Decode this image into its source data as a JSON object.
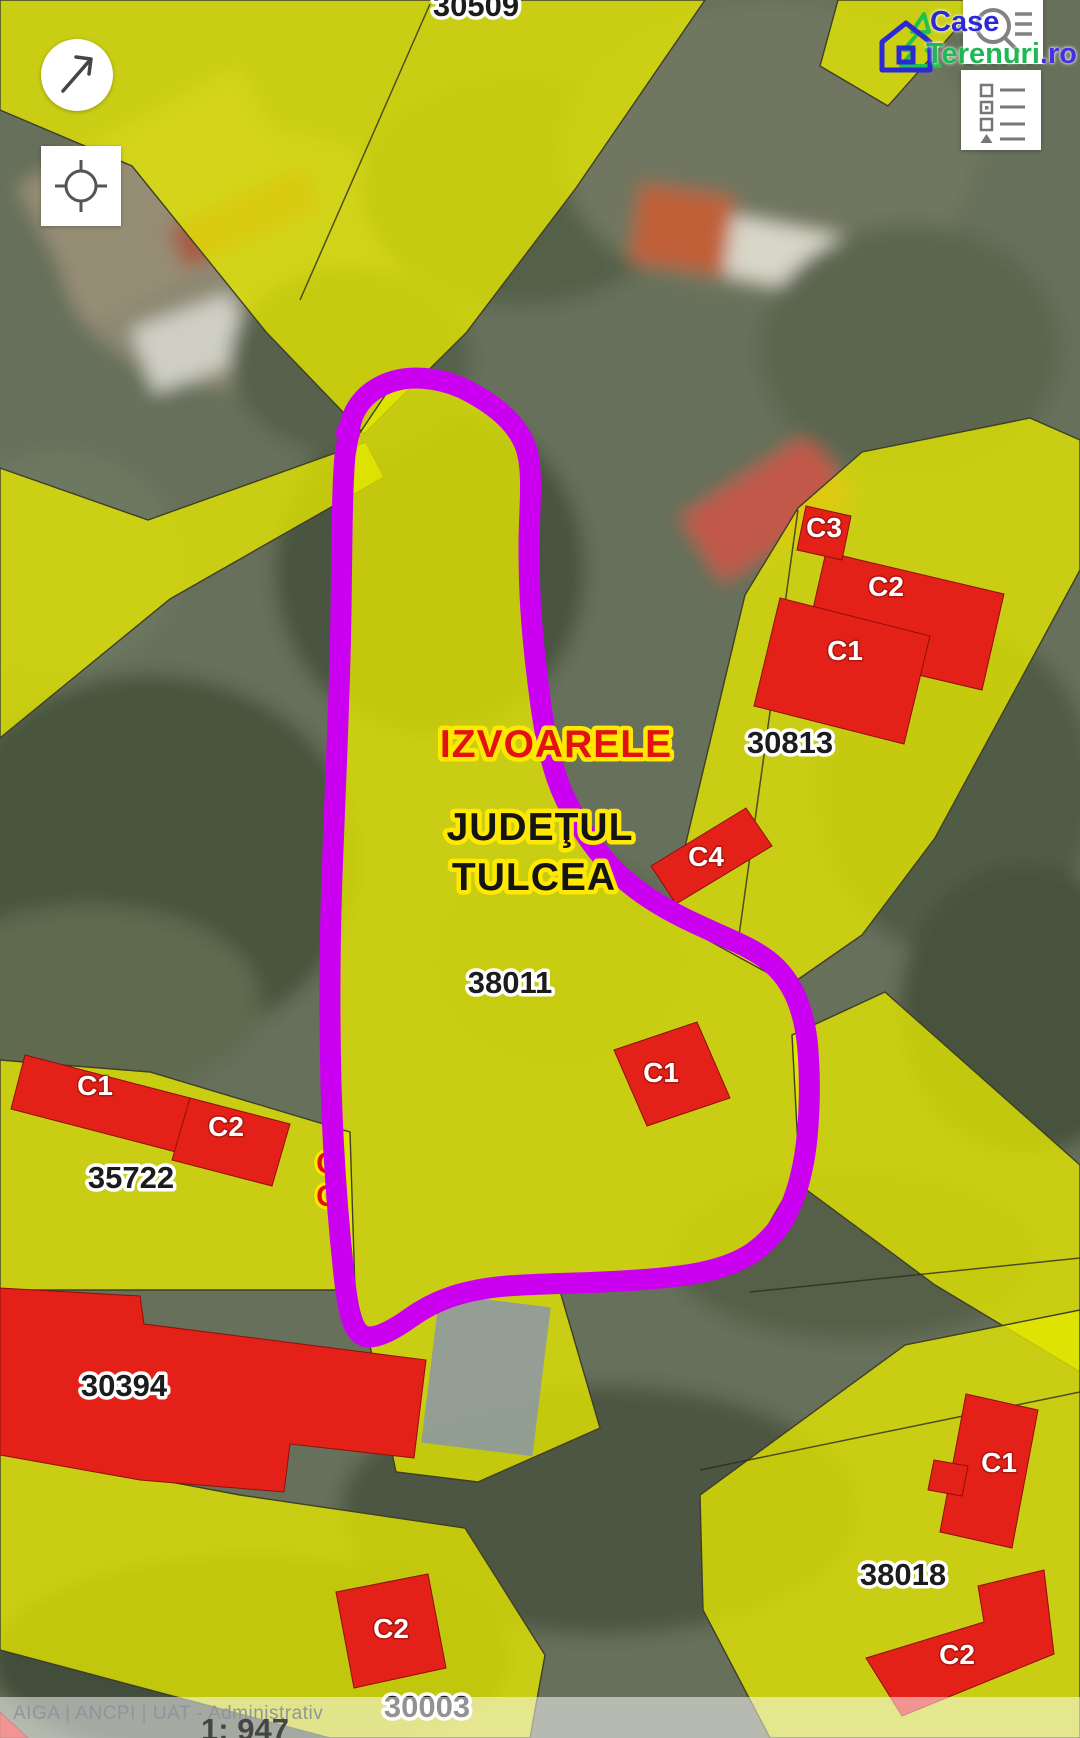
{
  "brand": {
    "name_part1": "Case",
    "name_part2": "Terenuri",
    "tld": ".ro"
  },
  "controls": {
    "compass_icon": "north-east-arrow",
    "locate_icon": "crosshair",
    "search_icon": "magnifier-with-list",
    "layers_icon": "legend-list"
  },
  "map": {
    "place_labels": {
      "town": "IZVOARELE",
      "county_line1": "JUDEŢUL",
      "county_line2": "TULCEA"
    },
    "parcel_numbers": {
      "p30509": "30509",
      "p30813": "30813",
      "p38011": "38011",
      "p35722": "35722",
      "p30394": "30394",
      "p38018": "38018",
      "p30003": "30003"
    },
    "building_labels": {
      "c1": "C1",
      "c2": "C2",
      "c3": "C3",
      "c4": "C4",
      "partial": "C"
    }
  },
  "footer": {
    "attribution": "AIGA | ANCPI | UAT - Administrativ",
    "scale": "1: 947"
  },
  "colors": {
    "parcel_yellow": "#e6e900",
    "building_red": "#e32119",
    "highlight_magenta": "#cc00f0",
    "label_halo_yellow": "#ffe900",
    "town_label_red": "#e21212",
    "logo_blue": "#2b28d4",
    "logo_green": "#1fc24d"
  }
}
